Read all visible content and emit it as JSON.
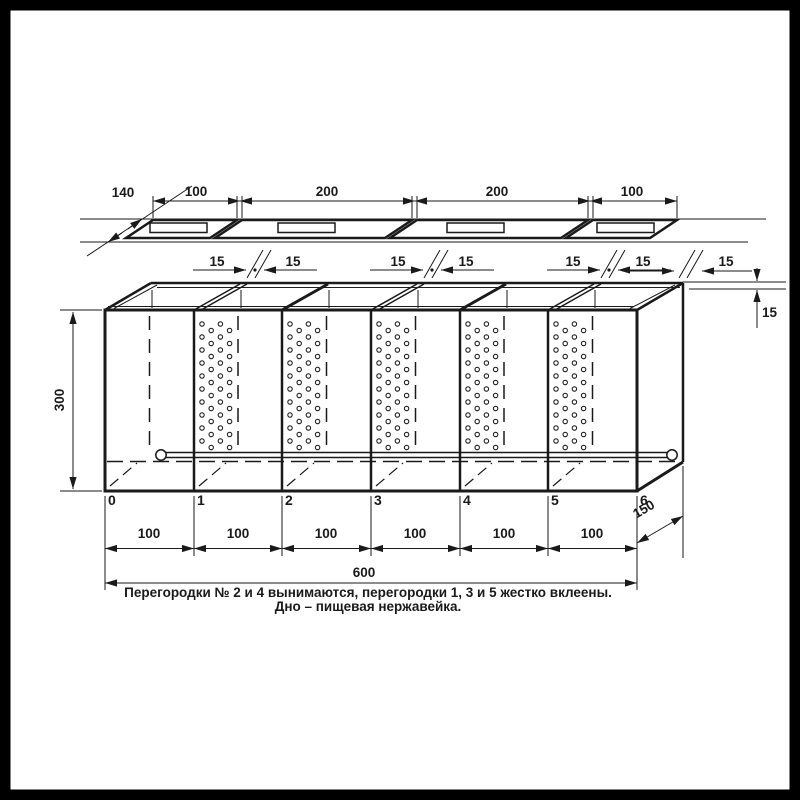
{
  "drawing": {
    "title_note_lines": {
      "line1": "Перегородки № 2 и 4 вынимаются, перегородки 1, 3 и 5  жестко вклеены.",
      "line2": "Дно – пищевая нержавейка."
    },
    "dims": {
      "lid_depth": "140",
      "lid_w": [
        "100",
        "200",
        "200",
        "100"
      ],
      "fifteens": [
        "15",
        "15",
        "15",
        "15",
        "15",
        "15",
        "15",
        "15"
      ],
      "height": "300",
      "comp": [
        "100",
        "100",
        "100",
        "100",
        "100",
        "100"
      ],
      "total": "600",
      "depth": "150"
    },
    "partition_numbers": [
      "0",
      "1",
      "2",
      "3",
      "4",
      "5",
      "6"
    ],
    "colors": {
      "ink": "#1a1a1a",
      "accent_red": "#d32020",
      "background": "#ffffff",
      "frame": "#000000"
    }
  }
}
